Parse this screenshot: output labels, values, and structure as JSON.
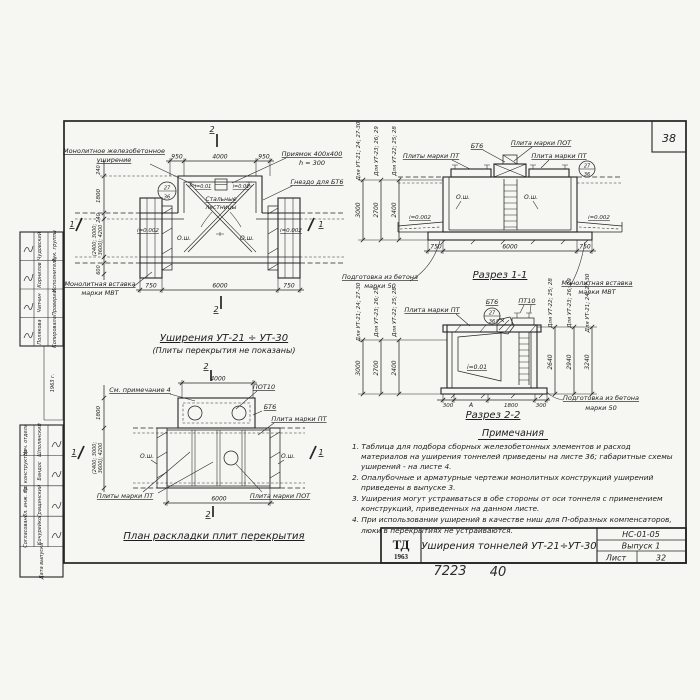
{
  "sheet": {
    "page_number": "38",
    "inventory_number": "7223",
    "page_handwritten": "40"
  },
  "title_block": {
    "logo": "ТД",
    "logo_year": "1963",
    "title": "Уширения тоннелей УТ-21÷УТ-30",
    "code": "НС-01-05",
    "issue": "Выпуск 1",
    "sheet_label": "Лист",
    "sheet_number": "32"
  },
  "sidebar": {
    "upper": {
      "rows": [
        {
          "role": "Рук. группы",
          "name": "Чудовский"
        },
        {
          "role": "Исполнитель",
          "name": "Корнилов"
        },
        {
          "role": "Проверил",
          "name": "Чапчин"
        },
        {
          "role": "Копировала",
          "name": "Полякова"
        }
      ],
      "year": "1963 г."
    },
    "lower": {
      "rows": [
        {
          "role": "Нач. отдела",
          "name": "Шполянский"
        },
        {
          "role": "Гл. конструктор",
          "name": "Бандос"
        },
        {
          "role": "Гл. инж. пр.",
          "name": "Гращинский"
        },
        {
          "role": "Согласовано",
          "name": "Кочурейко"
        }
      ],
      "footer": "Дата выпуска"
    }
  },
  "plan": {
    "title": "Уширения УТ-21 ÷ УТ-30",
    "subtitle": "(Плиты перекрытия не показаны)",
    "label_monolithic_1": "Монолитное железобетонное",
    "label_monolithic_2": "уширение",
    "label_pit_1": "Приямок 400х400",
    "label_pit_2": "h = 300",
    "label_socket": "Гнездо для БТ6",
    "label_ladders_1": "Стальные",
    "label_ladders_2": "лестницы",
    "label_insert_1": "Монолитная вставка",
    "label_insert_2": "марки МВТ",
    "detail_ref_top": "27",
    "detail_ref_bottom": "36",
    "slope_pit_left": "i=0.01",
    "slope_pit_right": "i=0.01",
    "slope_left": "i=0.002",
    "slope_right": "i=0.002",
    "axis_left": "О.ш.",
    "axis_right": "О.ш.",
    "dim_top_left": "950",
    "dim_top_mid": "4000",
    "dim_top_right": "950",
    "dim_bottom_left": "750",
    "dim_bottom_mid": "6000",
    "dim_bottom_right": "750",
    "dim_left_1": "240",
    "dim_left_2": "1800",
    "dim_left_3": "240",
    "dim_left_rot_1": "(2400; 3000;",
    "dim_left_rot_2": "3600); 4200",
    "dim_left_4": "600",
    "sec_mark_1": "1",
    "sec_mark_2": "2"
  },
  "section11": {
    "title": "Разрез 1-1",
    "label_pt_left": "Плиты марки ПТ",
    "label_bt6": "БТ6",
    "label_pot": "Плита марки ПОТ",
    "label_pt_right": "Плита марки ПТ",
    "detail_ref_top": "27",
    "detail_ref_bottom": "36",
    "axis_left": "О.ш.",
    "axis_right": "О.ш.",
    "slope_left": "i=0.002",
    "slope_right": "i=0.002",
    "label_prep_1": "Подготовка из бетона",
    "label_prep_2": "марки 50",
    "label_insert_1": "Монолитная вставка",
    "label_insert_2": "марки МВТ",
    "dim_bottom_left": "750",
    "dim_bottom_mid": "6000",
    "dim_bottom_right": "750",
    "dim_lines": [
      {
        "label": "Для УТ-21; 24; 27-30",
        "value": "3000"
      },
      {
        "label": "Для УТ-23; 26; 29",
        "value": "2700"
      },
      {
        "label": "Для УТ-22; 25; 28",
        "value": "2400"
      }
    ]
  },
  "section22": {
    "title": "Разрез 2-2",
    "label_pt": "Плита марки ПТ",
    "label_bt6": "БТ6",
    "label_pt10": "ПТ10",
    "detail_ref_top": "27",
    "detail_ref_bottom": "36",
    "slope": "i=0.01",
    "label_prep_1": "Подготовка из бетона",
    "label_prep_2": "марки 50",
    "dims_bottom": [
      "300",
      "А",
      "1800",
      "300"
    ],
    "dim_lines_left": [
      {
        "label": "Для УТ-21; 24; 27-30",
        "value": "3000"
      },
      {
        "label": "Для УТ-23; 26; 29",
        "value": "2700"
      },
      {
        "label": "Для УТ-22; 25; 28",
        "value": "2400"
      }
    ],
    "dim_lines_right": [
      {
        "label": "Для УТ-22; 25; 28",
        "value": "2640"
      },
      {
        "label": "Для УТ-23; 26; 29",
        "value": "2940"
      },
      {
        "label": "Для УТ-21; 24; 27-30",
        "value": "3240"
      }
    ]
  },
  "slab_plan": {
    "title": "План раскладки плит перекрытия",
    "label_note": "См. примечание 4",
    "label_pot10": "ПОТ10",
    "label_bt6": "БТ6",
    "label_pt_right": "Плита марки ПТ",
    "label_pt_left": "Плиты марки ПТ",
    "label_pot": "Плита марки ПОТ",
    "axis_left": "О.ш.",
    "axis_right": "О.ш.",
    "dim_top": "4000",
    "dim_bottom": "6000",
    "dim_left_1": "1800",
    "dim_left_rot_1": "(2400; 3000;",
    "dim_left_rot_2": "3600); 4200",
    "sec_mark_1": "1",
    "sec_mark_2": "2"
  },
  "notes": {
    "header": "Примечания",
    "items": [
      "1. Таблица для подбора сборных железобетонных элементов и расход материалов на уширения тоннелей приведены на листе 36; габаритные схемы уширений - на листе 4.",
      "2. Опалубочные и арматурные чертежи монолитных конструкций уширений приведены в выпуске 3.",
      "3. Уширения могут устраиваться в обе стороны от оси тоннеля с применением конструкций, приведенных на данном листе.",
      "4. При использовании уширений в качестве ниш для П-образных компенсаторов, люки в перекрытиях не устраиваются."
    ]
  }
}
